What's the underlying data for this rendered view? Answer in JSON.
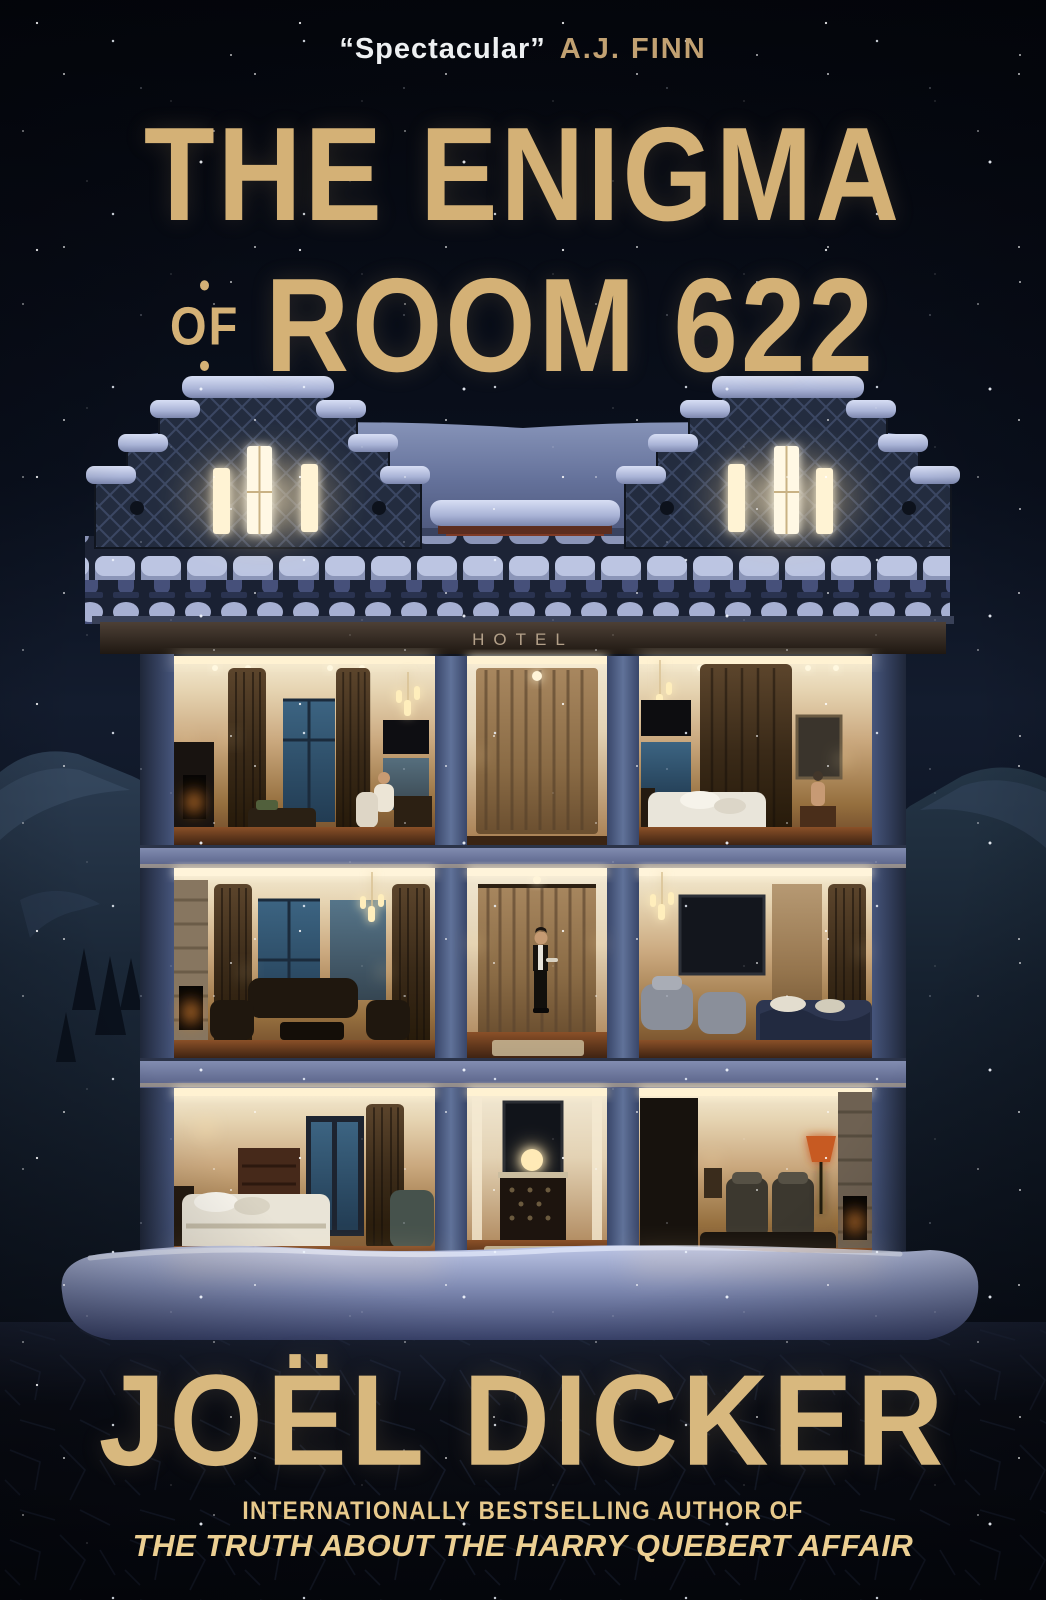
{
  "meta": {
    "type": "book-cover"
  },
  "quote": {
    "text": "“Spectacular”",
    "attribution": "A.J. FINN"
  },
  "title": {
    "line1": "THE ENIGMA",
    "of": "OF",
    "line2": "ROOM 622",
    "dot": "•"
  },
  "building": {
    "sign": "HOTEL"
  },
  "author": "JOËL DICKER",
  "footer": {
    "kicker": "INTERNATIONALLY BESTSELLING AUTHOR OF",
    "work": "THE TRUTH ABOUT THE HARRY QUEBERT AFFAIR"
  },
  "colors": {
    "gold": "#d4b176",
    "gold_bright": "#eccf92",
    "white": "#eef0f2",
    "sky": "#0a101d",
    "column_blue": "#5e7099",
    "snow": "#b7c0e2",
    "fire": "#ff8a24"
  }
}
